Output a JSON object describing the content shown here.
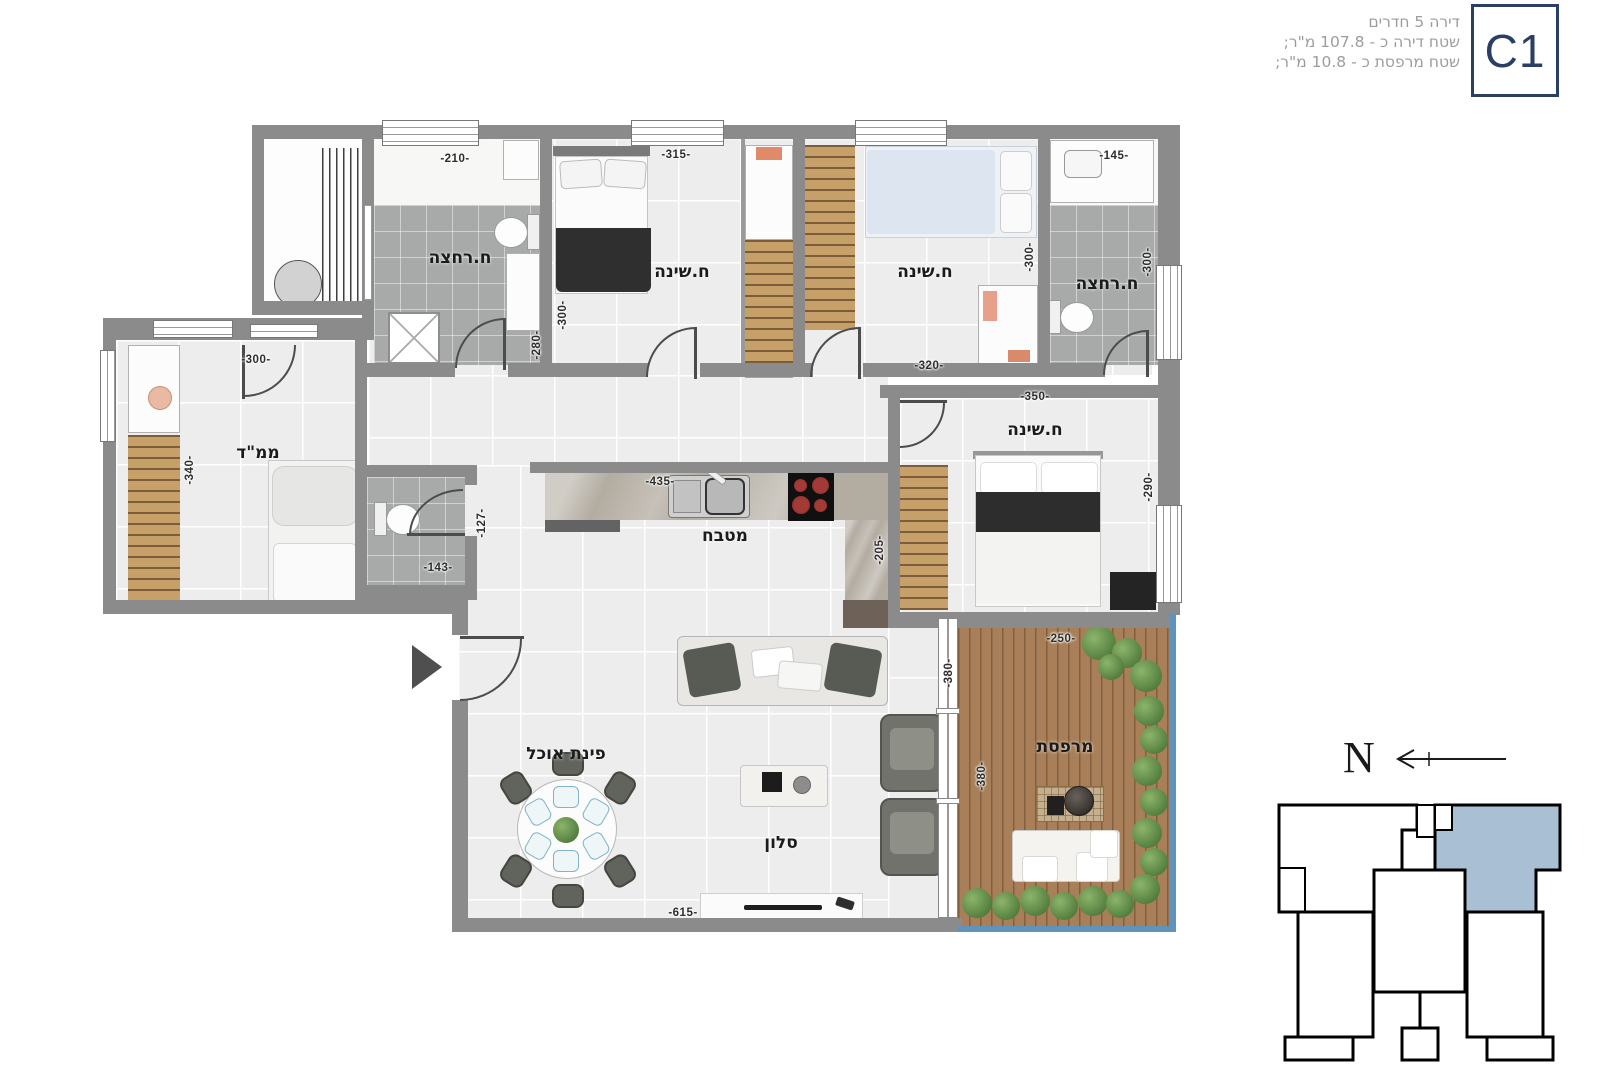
{
  "header": {
    "line1": "דירה 5 חדרים",
    "line2": "שטח דירה כ - 107.8 מ\"ר;",
    "line3": "שטח מרפסת כ - 10.8 מ\"ר;",
    "unit_code": "C1"
  },
  "rooms": {
    "bath1": "ח.רחצה",
    "bed1": "ח.שינה",
    "bed2": "ח.שינה",
    "bath2": "ח.רחצה",
    "mamad": "ממ\"ד",
    "kitchen": "מטבח",
    "master": "ח.שינה",
    "dining": "פינת אוכל",
    "living": "סלון",
    "balcony": "מרפסת"
  },
  "dims": {
    "bath1_w": "-210-",
    "bath1_h": "-280-",
    "bed1_w": "-315-",
    "bed1_h": "-300-",
    "bed2_w": "-320-",
    "bed2_h": "-300-",
    "bath2_w": "-145-",
    "bath2_h": "-300-",
    "mamad_w": "-300-",
    "mamad_h": "-340-",
    "wc_w": "-143-",
    "wc_h": "-127-",
    "kitchen_w": "-435-",
    "kitchen_h": "-205-",
    "master_w": "-350-",
    "master_h": "-290-",
    "living_w": "-615-",
    "living_window": "-380-",
    "balcony_w": "-250-",
    "balcony_h": "-380-"
  },
  "compass": {
    "north": "N"
  },
  "colors": {
    "wall": "#8b8b8b",
    "accent_navy": "#2a3f63",
    "keyplan_highlight": "#a9bfd4",
    "railing_blue": "#5f93bb"
  }
}
